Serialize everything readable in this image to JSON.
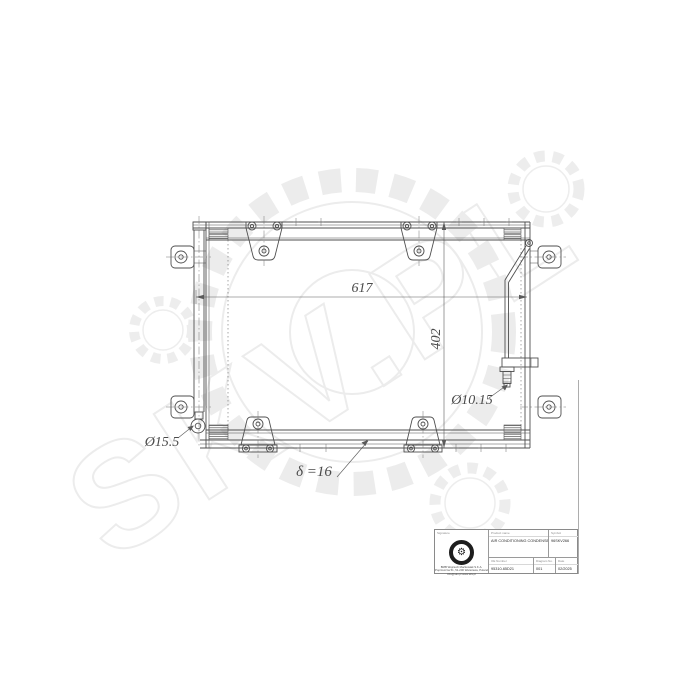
{
  "page": {
    "background": "#ffffff"
  },
  "watermark": {
    "text": "SKV.PL",
    "color": "#ececec"
  },
  "drawing": {
    "line_color": "#4f4f4f",
    "dimensions": {
      "width": "617",
      "height": "402",
      "outlet_diameter": "Ø10.15",
      "inlet_diameter": "Ø15.5",
      "thickness": "δ =16"
    }
  },
  "title_block": {
    "signature": {
      "label": "Signature",
      "company_lines": [
        "BMB Wojciech Maćkowiak S.K.A.",
        "Poprzeczna 51, 51-200 Warszawa, Poland",
        "info@skv.pl  www.skv.pl"
      ]
    },
    "product": {
      "label": "Product name",
      "value": "AIR CONDITIONING CONDENSER"
    },
    "symbol": {
      "label": "Symbol",
      "value": "96SKV266"
    },
    "oe_number": {
      "label": "OE Number",
      "value": "95310-65D21"
    },
    "diagram_no": {
      "label": "Diagram No.",
      "value": "001"
    },
    "date": {
      "label": "Date",
      "value": "02/2025"
    }
  }
}
